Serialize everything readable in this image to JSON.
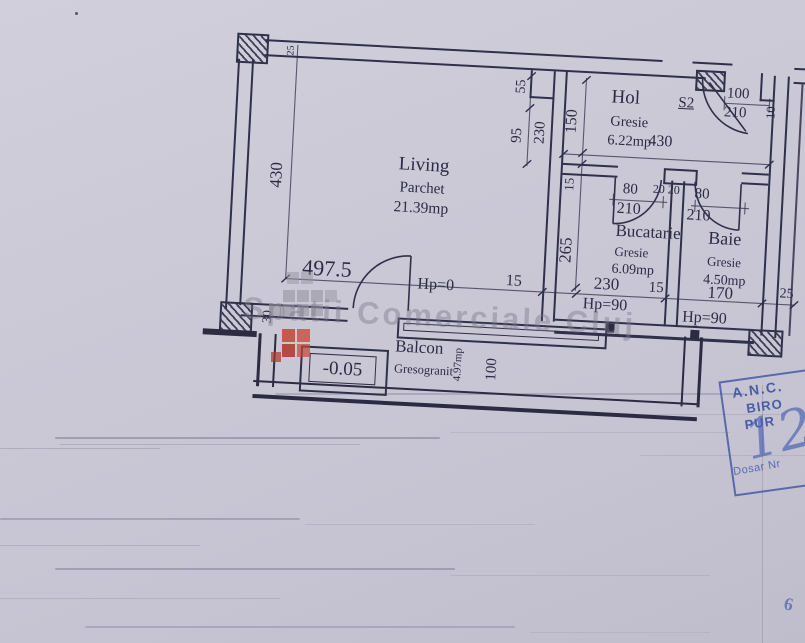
{
  "watermark": {
    "text": "Spatii Comerciale Cluj"
  },
  "rooms": {
    "living": {
      "name": "Living",
      "finish": "Parchet",
      "area": "21.39mp"
    },
    "hol": {
      "name": "Hol",
      "finish": "Gresie",
      "area": "6.22mp"
    },
    "bucatarie": {
      "name": "Bucatarie",
      "finish": "Gresie",
      "area": "6.09mp"
    },
    "baie": {
      "name": "Baie",
      "finish": "Gresie",
      "area": "4.50mp"
    },
    "balcon": {
      "name": "Balcon",
      "finish": "Gresogranit",
      "area": "4.97mp"
    }
  },
  "labels": {
    "unit": "S2",
    "level": "-0.05",
    "hp_living": "Hp=0",
    "hp_bucatarie": "Hp=90",
    "hp_baie": "Hp=90"
  },
  "dims": {
    "living_height": "430",
    "wall_top": "25",
    "corner_30": "30",
    "living_width": "497.5",
    "bottom_15": "15",
    "mid_55": "55",
    "mid_95": "95",
    "mid_230": "230",
    "mid_150": "150",
    "mid_15": "15",
    "mid_265": "265",
    "entry_width": "100",
    "entry_height": "210",
    "entry_jamb": "10",
    "hol_width": "430",
    "buc_door": "80",
    "stub_a": "20",
    "stub_b": "20",
    "baie_door": "80",
    "buc_door_h": "210",
    "baie_door_h": "210",
    "buc_width": "230",
    "buc_15": "15",
    "baie_width": "170",
    "right_25": "25",
    "balcon_depth": "100"
  },
  "stamp": {
    "line1": "A.N.C.",
    "line2": "BIRO",
    "line3": "PUR",
    "dosar": "Dosar Nr",
    "handwritten": "12",
    "corner_mark": "6"
  },
  "colors": {
    "ink": "#31304a",
    "stamp_blue": "#3c57a6",
    "logo_red": "#c44536",
    "paper": "#cac8d5"
  }
}
